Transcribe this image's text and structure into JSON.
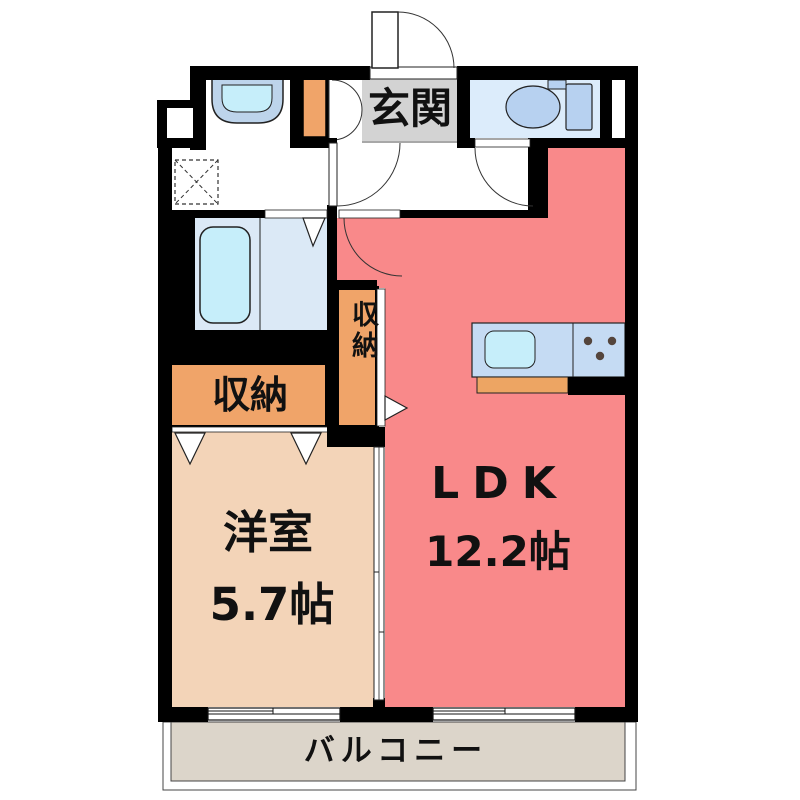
{
  "plan": {
    "entrance_label": "玄関",
    "ldk_label": "LDK",
    "ldk_area": "12.2帖",
    "western_room_label": "洋室",
    "western_room_area": "5.7帖",
    "closet_label": "収納",
    "tall_closet_label": "収納",
    "balcony_label": "バルコニー"
  },
  "colors": {
    "wall": "#000000",
    "ldk": "#f9898a",
    "western_room": "#f3d4b8",
    "closet": "#f0a469",
    "entrance": "#d3d3d3",
    "balcony": "#dcd5ca",
    "bath_floor": "#dbe9f6",
    "toilet_floor": "#dcecfb",
    "fixture_blue": "#b7d1f0",
    "vanity_blue": "#bdd4eb",
    "counter": "#c5dbf3",
    "basin": "#c6eefa",
    "counter_front": "#eda563",
    "burner": "#54453c",
    "text": "#111111",
    "outline": "#222222"
  },
  "fixture_icons": [
    "entrance-door-icon",
    "shoe-cabinet-icon",
    "washbasin-icon",
    "washer-space-icon",
    "meter-box-icon",
    "bathtub-icon",
    "bathroom-folding-door-icon",
    "toilet-icon",
    "pipe-space-icon",
    "kitchen-counter-icon",
    "kitchen-sink-icon",
    "gas-stove-icon",
    "sliding-window-icon",
    "sliding-door-icon",
    "closet-folding-door-icon",
    "swing-door-icon"
  ]
}
